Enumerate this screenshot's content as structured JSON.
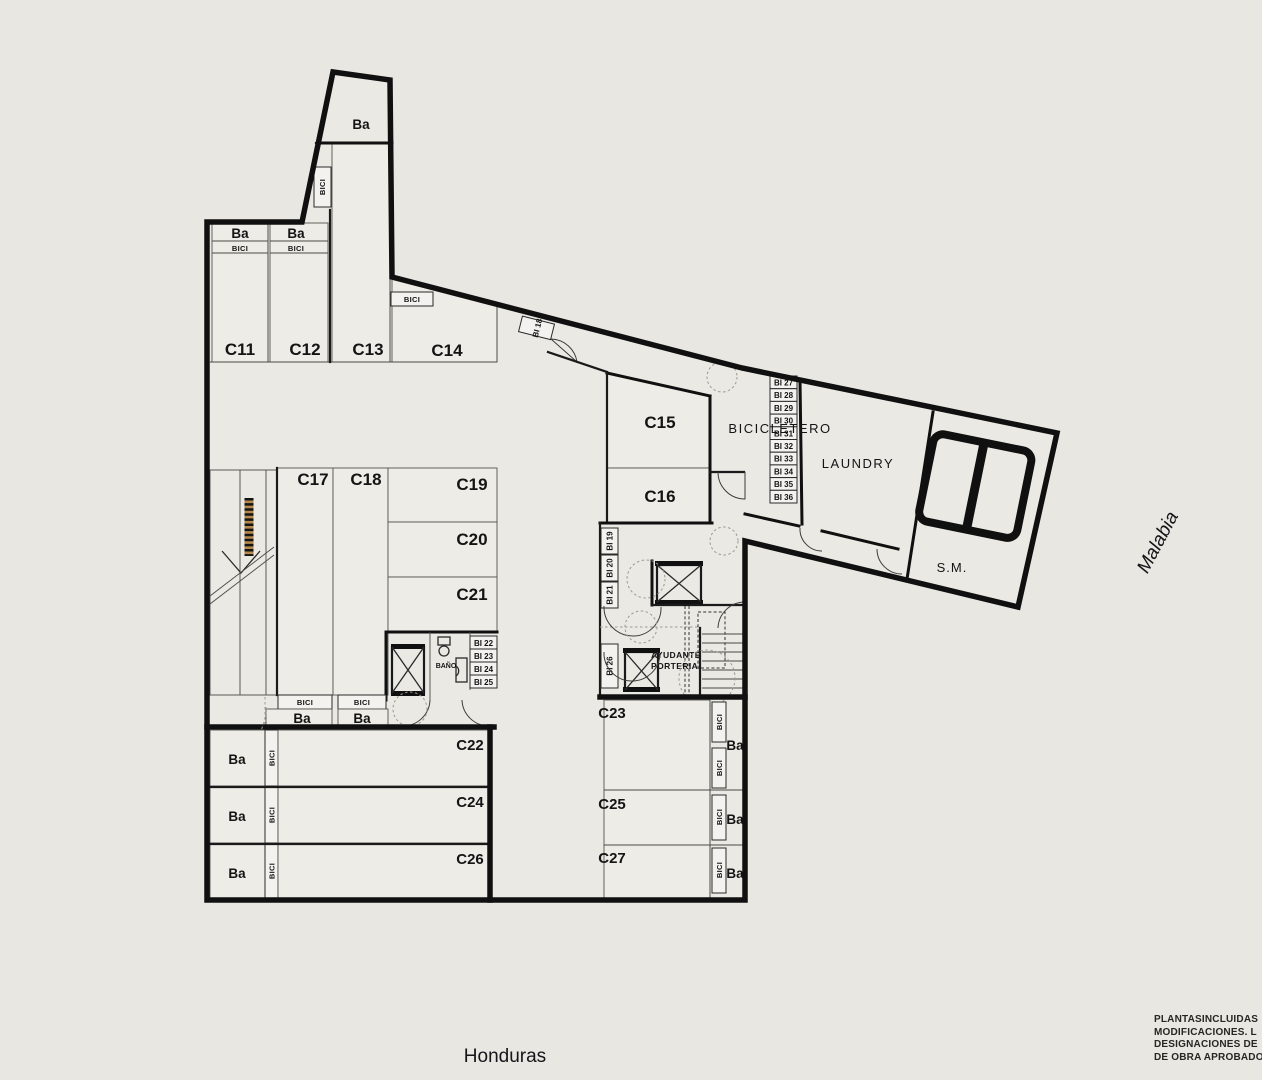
{
  "labels": {
    "ba": "Ba",
    "bici": "BICI",
    "c11": "C11",
    "c12": "C12",
    "c13": "C13",
    "c14": "C14",
    "c15": "C15",
    "c16": "C16",
    "c17": "C17",
    "c18": "C18",
    "c19": "C19",
    "c20": "C20",
    "c21": "C21",
    "c22": "C22",
    "c23": "C23",
    "c24": "C24",
    "c25": "C25",
    "c26": "C26",
    "c27": "C27",
    "bi18": "BI 18",
    "bi19": "BI 19",
    "bi20": "BI 20",
    "bi21": "BI 21",
    "bi22": "BI 22",
    "bi23": "BI 23",
    "bi24": "BI 24",
    "bi25": "BI 25",
    "bi26": "BI 26",
    "bicicletero": "BICICLETERO",
    "laundry": "LAUNDRY",
    "sm": "S.M.",
    "bano": "BAÑO",
    "ayudante1": "AYUDANTE",
    "ayudante2": "PORTERIA."
  },
  "bike_rack": [
    "BI 27",
    "BI 28",
    "BI 29",
    "BI 30",
    "BI 31",
    "BI 32",
    "BI 33",
    "BI 34",
    "BI 35",
    "BI 36"
  ],
  "streets": {
    "bottom": "Honduras",
    "right": "Malabia"
  },
  "note_lines": [
    "PLANTASINCLUIDAS",
    "MODIFICACIONES. L",
    "DESIGNACIONES DE",
    "DE OBRA APROBADO"
  ],
  "colors": {
    "paper": "#e8e7e2",
    "wall": "#101010",
    "hatch": "#b5894e"
  }
}
